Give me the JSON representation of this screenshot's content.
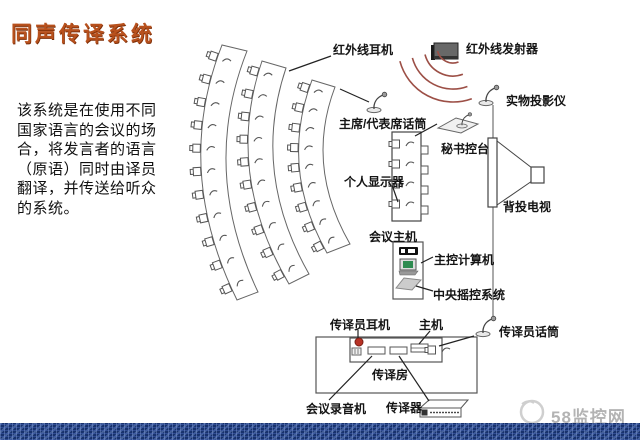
{
  "title": "同声传译系统",
  "intro": {
    "lines": [
      "该系统是在使用不同",
      "国家语言的会议的场",
      "合，将发言者的语言",
      "（原语）同时由译员",
      "翻译，并传送给听众",
      "的系统。"
    ]
  },
  "labels": {
    "infrared_headphone": "红外线耳机",
    "infrared_transmitter": "红外线发射器",
    "document_camera": "实物投影仪",
    "chairman_mic": "主席/代表席话筒",
    "secretary_console": "秘书控台",
    "personal_display": "个人显示器",
    "rear_projection_tv": "背投电视",
    "conference_host": "会议主机",
    "main_computer": "主控计算机",
    "central_control": "中央摇控系统",
    "interpreter_headphone": "传译员耳机",
    "booth_host": "主机",
    "interpreter_mic": "传译员话筒",
    "booth": "传译房",
    "conference_recorder": "会议录音机",
    "interpreter_unit": "传译器"
  },
  "watermark": "58监控网",
  "colors": {
    "title": "#b8511d",
    "wave_red": "#9c4f46",
    "red_dot": "#b73225",
    "screen_green": "#2e8b50",
    "bottom_bar": "#1c3a78",
    "watermark_gray": "#b3b3b3",
    "line_dark": "#3a3a3a"
  },
  "diagram": {
    "seat_rows": 3,
    "seat_counts": [
      11,
      10,
      9
    ],
    "wave_count": 4
  },
  "icons": {
    "seat-icon": "chair with infrared receiver mark",
    "gooseneck-mic-icon": "microphone on curved neck with oval base",
    "infrared-transmitter-icon": "dark wall-mounted emitter box",
    "wave-icon": "red radiating arcs",
    "rear-tv-icon": "screen bar with projection cone and projector box",
    "computer-icon": "monitor with green screen",
    "rack-device-icon": "flat rack unit with dotted front panel",
    "red-dot-icon": "red indicator dot",
    "swirl-logo-icon": "gray circular watermark logo"
  }
}
